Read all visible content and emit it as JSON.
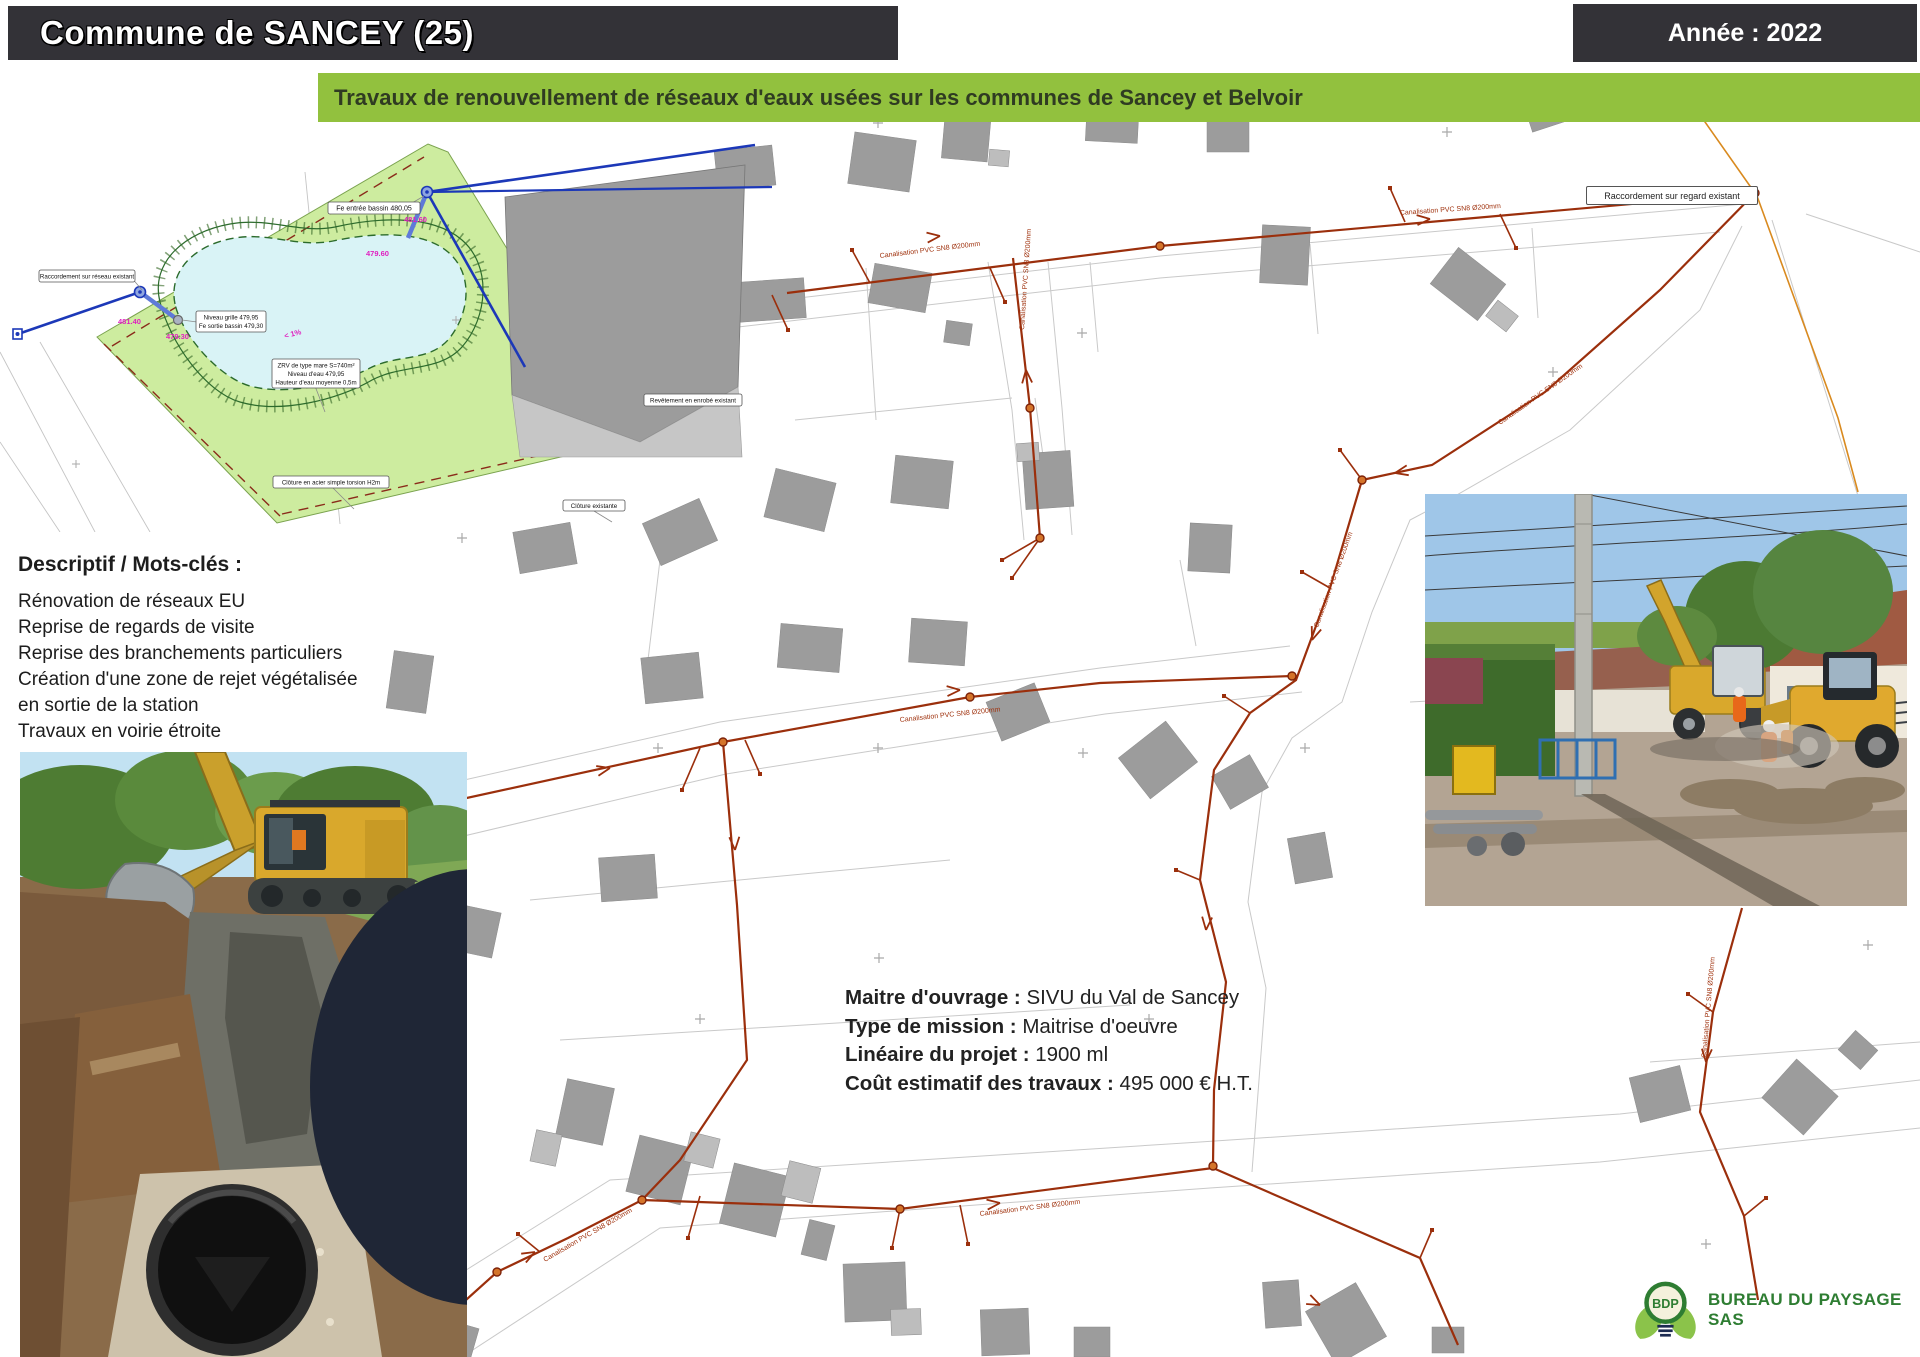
{
  "header": {
    "title": "Commune de SANCEY (25)",
    "year": "Année : 2022"
  },
  "banner": {
    "text": "Travaux de renouvellement de réseaux d'eaux usées sur les communes de Sancey et Belvoir"
  },
  "plan": {
    "labels": {
      "fe_entree": "Fe entrée bassin 480,05",
      "raccordement_reseau": "Raccordement sur réseau existant",
      "niveau_grille": "Niveau grille 479,95",
      "fe_sortie": "Fe sortie bassin 479,30",
      "zrv_1": "ZRV de type mare S=740m²",
      "zrv_2": "Niveau d'eau 479,95",
      "zrv_3": "Hauteur d'eau moyenne 0,5m",
      "cloture_acier": "Clôture en acier simple torsion H2m",
      "cloture_existante": "Clôture existante",
      "revetement": "Revêtement en enrobé existant",
      "elev_1": "481.40",
      "elev_2": "479.30",
      "elev_3": "481.60",
      "elev_4": "479.60",
      "pente": "< 1%"
    }
  },
  "map": {
    "pipe_label": "Canalisation PVC SN8 Ø200mm",
    "raccordement_regard": "Raccordement sur regard existant"
  },
  "descriptif": {
    "heading": "Descriptif / Mots-clés :",
    "lines": [
      "Rénovation de réseaux EU",
      "Reprise de regards de visite",
      "Reprise des branchements particuliers",
      "Création d'une zone de rejet végétalisée",
      "en sortie de la station",
      "Travaux en voirie étroite"
    ]
  },
  "project": {
    "rows": [
      {
        "label": "Maitre d'ouvrage : ",
        "value": "SIVU du Val de Sancey"
      },
      {
        "label": "Type de mission : ",
        "value": "Maitrise d'oeuvre"
      },
      {
        "label": "Linéaire du projet : ",
        "value": "1900 ml"
      },
      {
        "label": "Coût estimatif des travaux : ",
        "value": "495 000 € H.T."
      }
    ]
  },
  "logo": {
    "acronym": "BDP",
    "company": "BUREAU DU PAYSAGE SAS"
  },
  "colors": {
    "header_bg": "#333237",
    "banner_bg": "#92C13E",
    "pipe": "#9B2F0C",
    "plan_green": "#CDEC9F",
    "pond": "#D9F3F6",
    "logo_green": "#2E7D32",
    "leaf_green": "#8BC34A"
  }
}
